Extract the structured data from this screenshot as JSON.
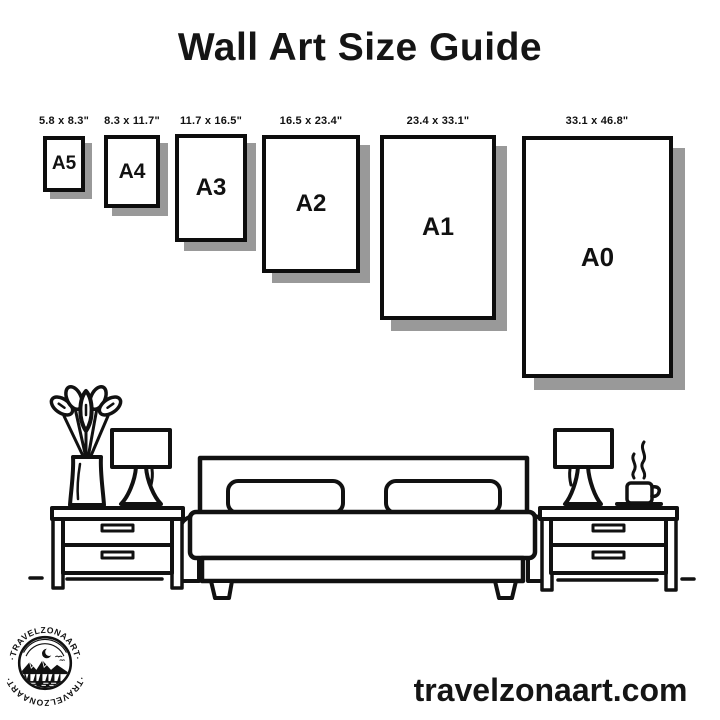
{
  "title": "Wall Art Size Guide",
  "size_guide": {
    "frames": [
      {
        "label": "A5",
        "dimensions": "5.8 x 8.3\""
      },
      {
        "label": "A4",
        "dimensions": "8.3 x 11.7\""
      },
      {
        "label": "A3",
        "dimensions": "11.7 x 16.5\""
      },
      {
        "label": "A2",
        "dimensions": "16.5 x 23.4\""
      },
      {
        "label": "A1",
        "dimensions": "23.4 x 33.1\""
      },
      {
        "label": "A0",
        "dimensions": "33.1 x 46.8\""
      }
    ]
  },
  "scene": {
    "items": [
      "potted-plant",
      "table-lamp-left",
      "nightstand-left",
      "double-bed",
      "table-lamp-right",
      "coffee-cup",
      "nightstand-right"
    ]
  },
  "footer": {
    "website": "travelzonaart.com",
    "logo_text_top": "·TRAVELZONAART·",
    "logo_text_bottom": "·TRAVELZONAART·"
  },
  "colors": {
    "ink": "#111111",
    "shadow": "#999999",
    "background": "#ffffff"
  }
}
